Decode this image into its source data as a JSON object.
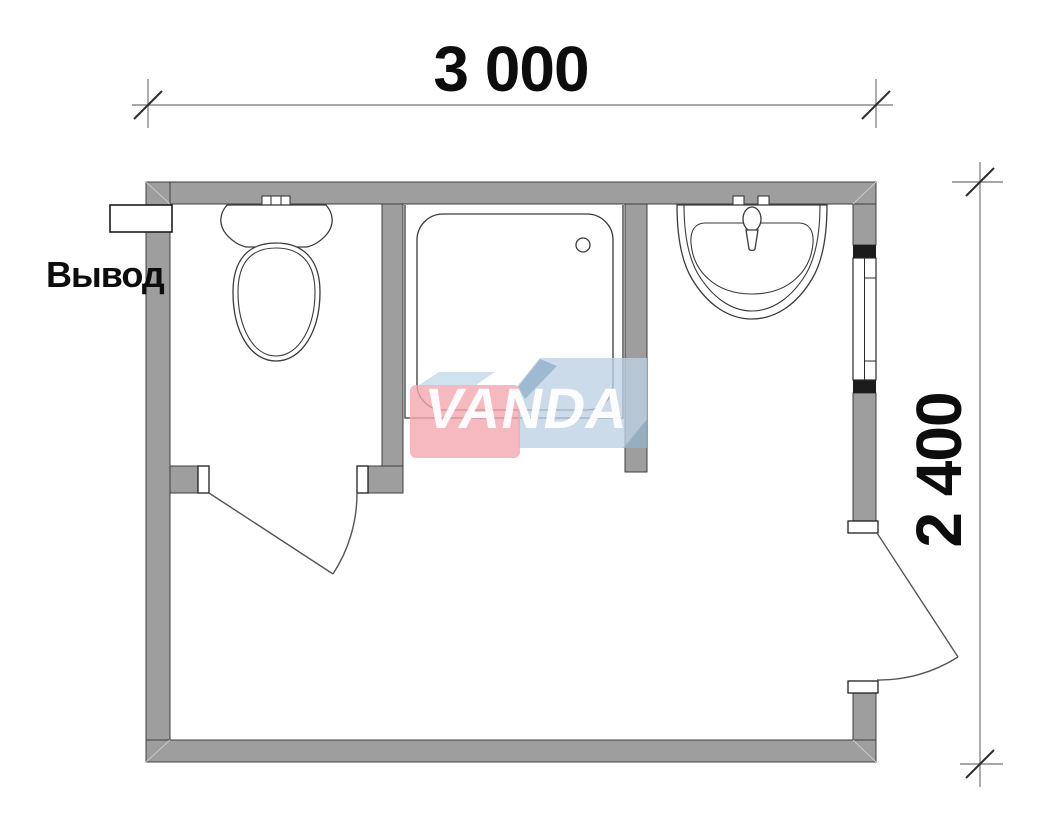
{
  "title": "Bathroom module floor plan",
  "dimensions": {
    "width_label": "3 000",
    "height_label": "2 400"
  },
  "labels": {
    "outlet": "Вывод"
  },
  "watermark": {
    "brand": "VANDA",
    "pink": "#f2a7af",
    "light_blue": "#bcd1e4",
    "dark_blue": "#92b1cb"
  },
  "colors": {
    "background": "#ffffff",
    "wall_fill": "#9e9e9e",
    "wall_outline": "#3f3f3f",
    "window_cap": "#1c1c1c",
    "fixture_line": "#3a3a3a",
    "door_line": "#555555",
    "dimension_line": "#8a8a8a",
    "dimension_tick": "#2e2e2e",
    "text": "#0d0d0d"
  },
  "fixtures": [
    "toilet",
    "shower-tray",
    "washbasin",
    "outlet-pipe",
    "window",
    "interior-door",
    "exterior-door"
  ]
}
